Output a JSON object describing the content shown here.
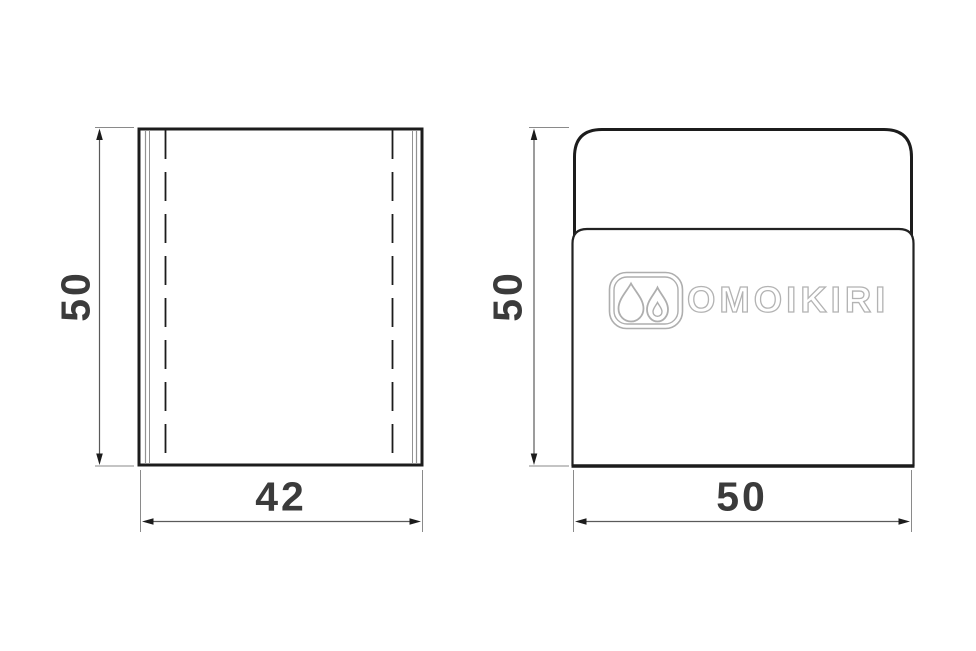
{
  "drawing": {
    "type": "technical-dimension-drawing",
    "views": {
      "side": {
        "name": "side view",
        "height_dim": "50",
        "width_dim": "42"
      },
      "front": {
        "name": "front view",
        "height_dim": "50",
        "width_dim": "50",
        "logo_text": "OMOIKIRI",
        "logo_icon": "water-drops-icon"
      }
    },
    "colors": {
      "outline": "#1c1c1c",
      "inner_edge_line": "#919191",
      "dimension_line": "#5a5a5a",
      "extension_line": "#8a8a8a",
      "dimension_text": "#3b3b3b",
      "logo_gray": "#b3b3b3",
      "background": "#ffffff"
    }
  }
}
